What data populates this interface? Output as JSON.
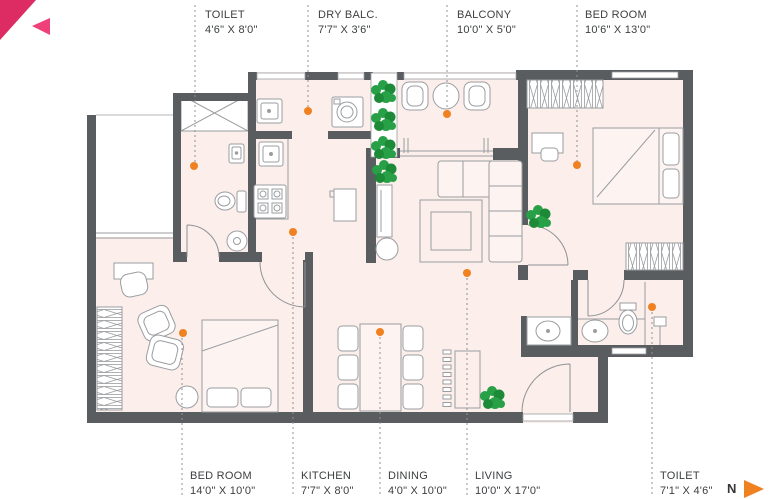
{
  "page": {
    "background": "#ffffff"
  },
  "brand": {
    "corner_triangle_color": "#dd2b63",
    "small_triangle_color": "#ee4079"
  },
  "colors": {
    "wall": "#5a5d60",
    "floor": "#fbeeeb",
    "furniture_line": "#9a9da0",
    "accent_orange": "#f08121",
    "plant_green": "#28a047",
    "plant_green_dark": "#1d8a38",
    "label_text": "#3c3e40",
    "leader_gray": "#8f9396"
  },
  "labels": {
    "top": [
      {
        "name": "TOILET",
        "dims": "4'6\" X 8'0\""
      },
      {
        "name": "DRY BALC.",
        "dims": "7'7\" X 3'6\""
      },
      {
        "name": "BALCONY",
        "dims": "10'0\" X 5'0\""
      },
      {
        "name": "BED ROOM",
        "dims": "10'6\" X 13'0\""
      }
    ],
    "bottom": [
      {
        "name": "BED ROOM",
        "dims": "14'0\" X 10'0\""
      },
      {
        "name": "KITCHEN",
        "dims": "7'7\" X 8'0\""
      },
      {
        "name": "DINING",
        "dims": "4'0\" X 10'0\""
      },
      {
        "name": "LIVING",
        "dims": "10'0\" X 17'0\""
      },
      {
        "name": "TOILET",
        "dims": "7'1\" X 4'6\""
      }
    ]
  },
  "compass": {
    "label": "N"
  }
}
